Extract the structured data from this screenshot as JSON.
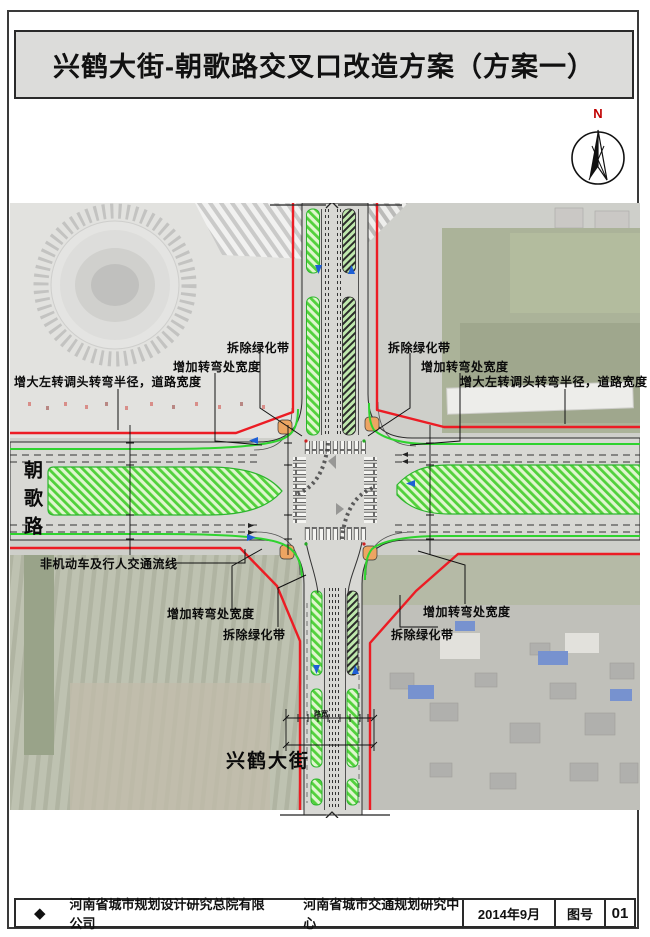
{
  "title": "兴鹤大街-朝歌路交叉口改造方案（方案一）",
  "north": {
    "label": "N"
  },
  "map": {
    "road_west": "朝歌路",
    "road_south": "兴鹤大街",
    "dimension_label": "路宽",
    "callouts": [
      {
        "id": "upper-left-demolish-greenbelt",
        "text": "拆除绿化带"
      },
      {
        "id": "upper-left-widen-turn",
        "text": "增加转弯处宽度"
      },
      {
        "id": "upper-left-enlarge-radius",
        "text": "增大左转调头转弯半径，道路宽度"
      },
      {
        "id": "upper-right-demolish-greenbelt",
        "text": "拆除绿化带"
      },
      {
        "id": "upper-right-widen-turn",
        "text": "增加转弯处宽度"
      },
      {
        "id": "upper-right-enlarge-radius",
        "text": "增大左转调头转弯半径，道路宽度"
      },
      {
        "id": "lower-left-nonmotor-flow",
        "text": "非机动车及行人交通流线"
      },
      {
        "id": "lower-left-widen-turn",
        "text": "增加转弯处宽度"
      },
      {
        "id": "lower-left-demolish-greenbelt",
        "text": "拆除绿化带"
      },
      {
        "id": "lower-right-widen-turn",
        "text": "增加转弯处宽度"
      },
      {
        "id": "lower-right-demolish-greenbelt",
        "text": "拆除绿化带"
      }
    ]
  },
  "footer": {
    "logo": "◆",
    "org1": "河南省城市规划设计研究总院有限公司",
    "org2": "河南省城市交通规划研究中心",
    "date": "2014年9月",
    "sheet_label": "图号",
    "sheet_no": "01"
  },
  "colors": {
    "boundary_red": "#ec1c24",
    "bike_green": "#2fd32f",
    "median_hatch_green": "#52d13c",
    "island_orange": "#eda562",
    "arrow_blue": "#1d5fd6"
  }
}
